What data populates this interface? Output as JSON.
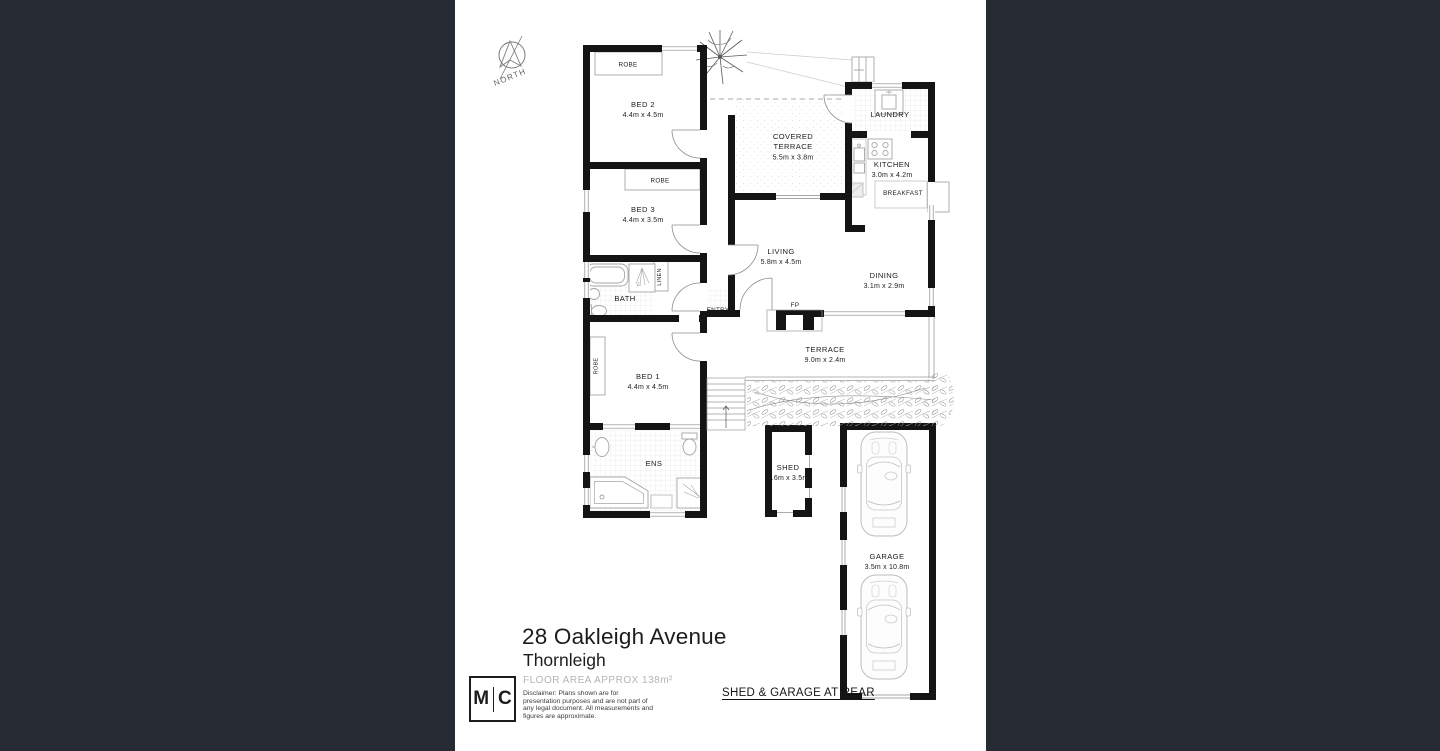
{
  "page": {
    "background_color": "#262b33",
    "canvas_color": "#ffffff"
  },
  "compass": {
    "label": "NORTH"
  },
  "floor_plan": {
    "labels": {
      "bed1": "BED 1",
      "bed1_dims": "4.4m x 4.5m",
      "bed2": "BED 2",
      "bed2_dims": "4.4m x 4.5m",
      "bed3": "BED 3",
      "bed3_dims": "4.4m x 3.5m",
      "robe": "ROBE",
      "linen": "LINEN",
      "bath": "BATH",
      "ens": "ENS",
      "entry": "ENTRY",
      "fp": "FP",
      "living": "LIVING",
      "living_dims": "5.8m x 4.5m",
      "dining": "DINING",
      "dining_dims": "3.1m x 2.9m",
      "kitchen": "KITCHEN",
      "kitchen_dims": "3.0m x 4.2m",
      "breakfast": "BREAKFAST",
      "laundry": "LAUNDRY",
      "covered_terrace_1": "COVERED",
      "covered_terrace_2": "TERRACE",
      "covered_terrace_dims": "5.5m x 3.8m",
      "terrace": "TERRACE",
      "terrace_dims": "9.0m x 2.4m",
      "shed": "SHED",
      "shed_dims": "1.6m x 3.5m",
      "garage": "GARAGE",
      "garage_dims": "3.5m x 10.8m"
    }
  },
  "title_block": {
    "address_line1": "28 Oakleigh Avenue",
    "address_line2": "Thornleigh",
    "floor_area": "FLOOR AREA APPROX 138m²",
    "disclaimer_lines": [
      "Disclaimer: Plans shown are for",
      "presentation purposes and are not part of",
      "any legal document. All measurements and",
      "figures are approximate."
    ],
    "rear_note": "SHED & GARAGE AT REAR",
    "logo_m": "M",
    "logo_c": "C"
  }
}
